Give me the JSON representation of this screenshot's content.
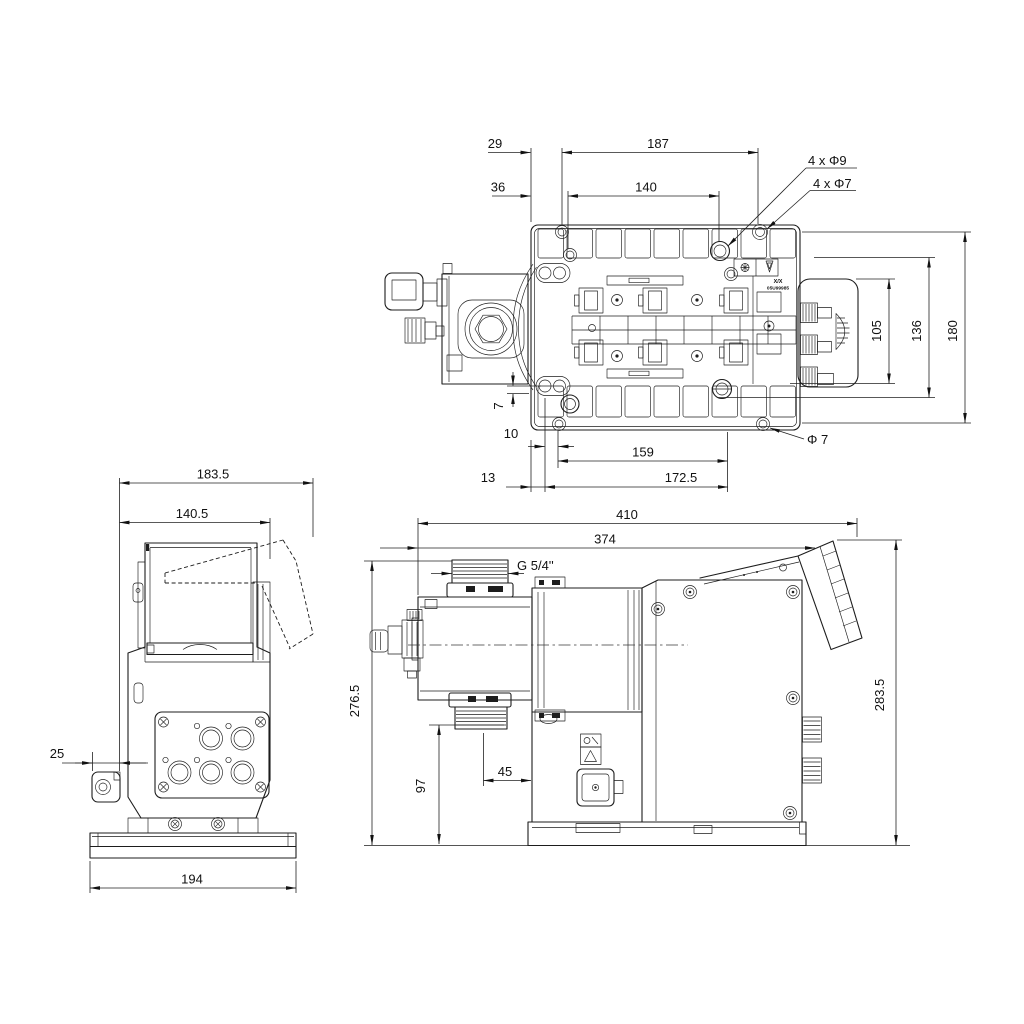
{
  "top_view": {
    "nameplate": {
      "line1": "X/X",
      "line2": "05U99985"
    },
    "dims": {
      "d29": "29",
      "d187": "187",
      "d36": "36",
      "d140": "140",
      "holes9": "4 x Φ9",
      "holes7": "4 x Φ7",
      "d105": "105",
      "d136": "136",
      "d180": "180",
      "d7": "7",
      "d10": "10",
      "d159": "159",
      "dia7": "Φ 7",
      "d13": "13",
      "d172_5": "172.5"
    }
  },
  "front_view": {
    "dims": {
      "d183_5": "183.5",
      "d140_5": "140.5",
      "d25": "25",
      "d194": "194"
    }
  },
  "side_view": {
    "dims": {
      "d410": "410",
      "d374": "374",
      "g_thread": "G 5/4''",
      "d276_5": "276.5",
      "d97": "97",
      "d45": "45",
      "d283_5": "283.5"
    }
  }
}
